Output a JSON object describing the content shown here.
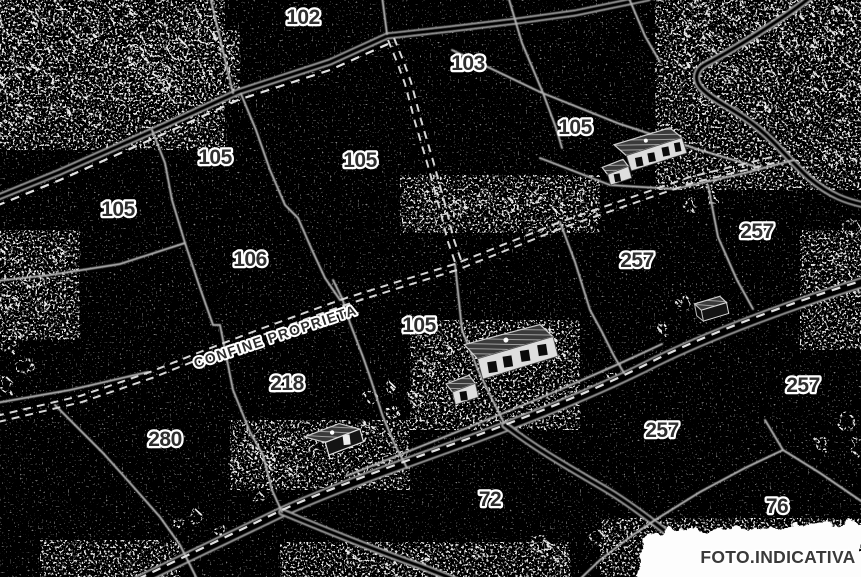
{
  "map": {
    "type": "cadastral-plan",
    "background_color": "#000000",
    "boundary_line_color": "#b3b3b3",
    "dashed_line_color": "#e2e2e2",
    "label_color": "#2e2e2e",
    "label_halo_color": "#ffffff",
    "parcel_labels": [
      {
        "text": "102",
        "x": 303,
        "y": 24
      },
      {
        "text": "103",
        "x": 468,
        "y": 70
      },
      {
        "text": "105",
        "x": 575,
        "y": 134
      },
      {
        "text": "105",
        "x": 215,
        "y": 164
      },
      {
        "text": "105",
        "x": 360,
        "y": 167
      },
      {
        "text": "105",
        "x": 118,
        "y": 216
      },
      {
        "text": "257",
        "x": 757,
        "y": 238
      },
      {
        "text": "106",
        "x": 250,
        "y": 266
      },
      {
        "text": "257",
        "x": 637,
        "y": 267
      },
      {
        "text": "105",
        "x": 419,
        "y": 332
      },
      {
        "text": "218",
        "x": 287,
        "y": 390
      },
      {
        "text": "257",
        "x": 803,
        "y": 392
      },
      {
        "text": "257",
        "x": 662,
        "y": 437
      },
      {
        "text": "280",
        "x": 165,
        "y": 446
      },
      {
        "text": "72",
        "x": 490,
        "y": 506
      },
      {
        "text": "76",
        "x": 777,
        "y": 513
      }
    ],
    "boundary_annotation": {
      "text": "CONFINE PROPRIETA",
      "rotation_deg": -18.5
    },
    "watermark": {
      "text": "FOTO.INDICATIVA"
    },
    "building_icons": [
      "large-farmhouse-with-annex",
      "farmhouse-with-annex",
      "small-shed",
      "small-house"
    ]
  }
}
